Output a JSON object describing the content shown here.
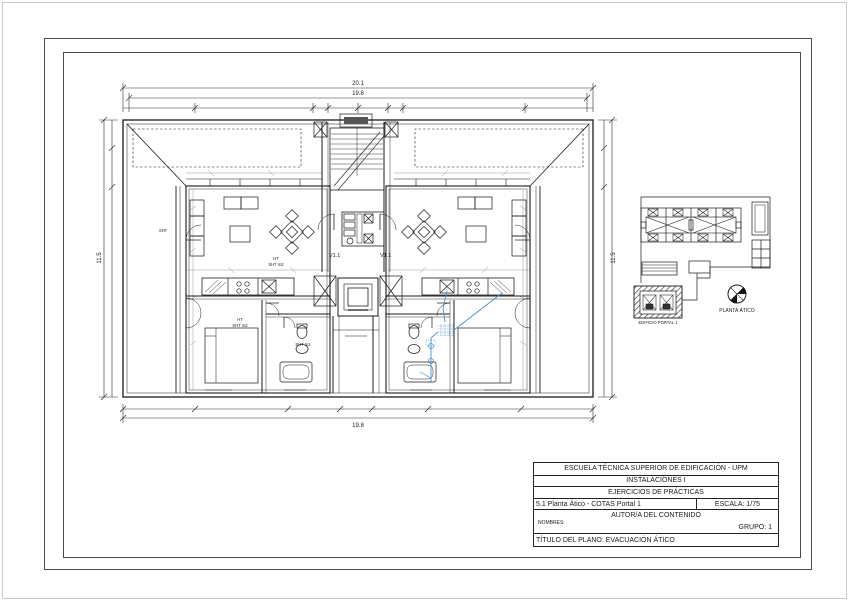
{
  "sheet": {
    "background": "#ffffff",
    "line_color": "#1b1b1b",
    "pipe_color": "#4a8fd3"
  },
  "dimensions": {
    "top_outer": "20.1",
    "top_inner": "19.8",
    "bottom_outer": "19.8",
    "left_overall": "11.5",
    "right_overall": "11.5"
  },
  "plan_labels": {
    "vent_left": "V1.1",
    "vent_right": "V1.1",
    "living_ht": "HT",
    "living_sht": "SHT m2",
    "bedroom_ht": "HT",
    "bedroom_sht": "SHT m2",
    "bath_sht": "SHT m2",
    "terrace_sht": "SHT"
  },
  "key_plan": {
    "building_label": "EDIFICIO PORTAL 1",
    "orientation_label": "PLANTA ÁTICO"
  },
  "title_block": {
    "row1": "ESCUELA TÉCNICA SUPERIOR DE EDIFICACIÓN - UPM",
    "row2": "INSTALACIONES I",
    "row3": "EJERCICIOS DE PRÁCTICAS",
    "row4_left": "5.1 Planta Ático - COTAS Portal 1",
    "row4_right": "ESCALA: 1/75",
    "author_header": "AUTOR/A DEL CONTENIDO",
    "names_label": "NOMBRES:",
    "group_label": "GRUPO: 1",
    "row6": "TÍTULO DEL PLANO: EVACUACIÓN ÁTICO"
  }
}
